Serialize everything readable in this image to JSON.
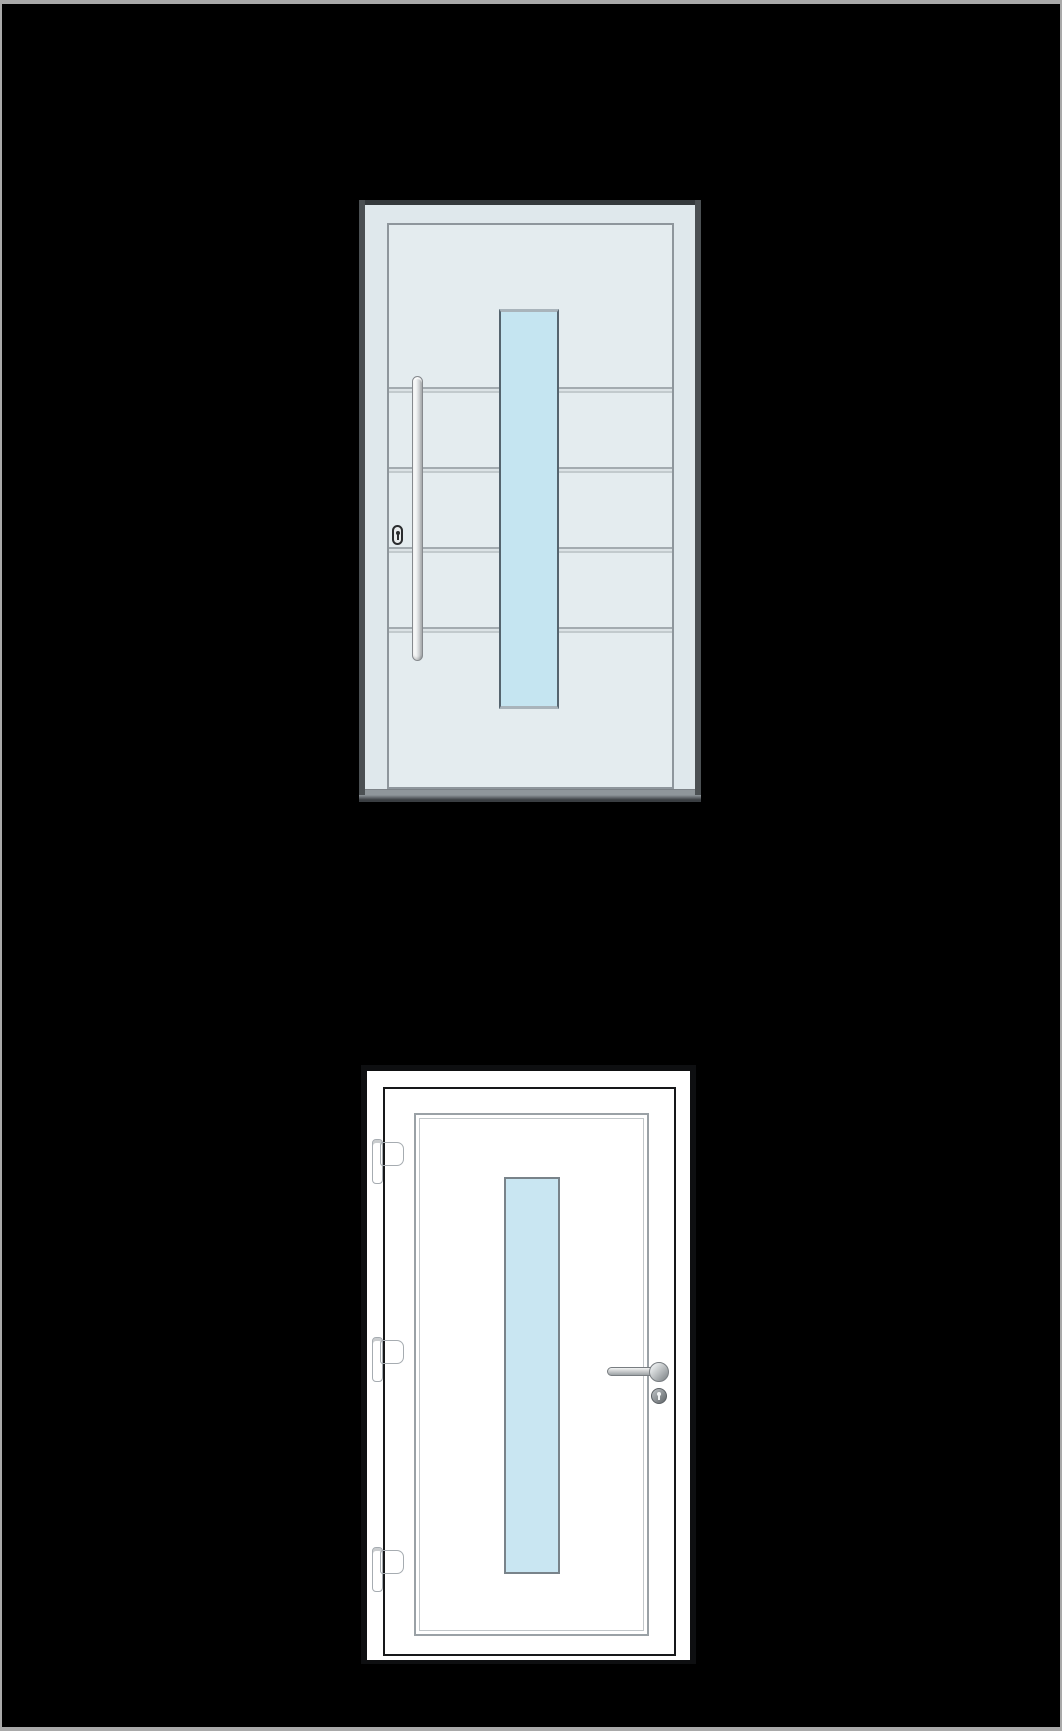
{
  "scene": {
    "kind": "two-entrance-door-product-illustrations",
    "background": "#000000",
    "page_border_color": "#a9a9a9"
  },
  "palette": {
    "bg": "#000000",
    "page_border": "#a9a9a9",
    "a_frame": "#dfe8ec",
    "a_leaf": "#e4ecef",
    "a_edge_top": "#34393c",
    "a_edge_side": "#4b5053",
    "a_edge_bottom": "#3a3e42",
    "a_leaf_line": "#8e969c",
    "a_groove_top": "#a3abb0",
    "a_groove_bottom": "#c2cacd",
    "a_groove_fill": "#dce3e6",
    "a_glass": "#c5e5f1",
    "a_glass_side": "#55646e",
    "a_glass_cap": "#a9b4bb",
    "a_handle_hi": "#fdfdfd",
    "a_handle_lo": "#9fa3a5",
    "a_handle_line": "#85898d",
    "a_lock_fill": "#e8ebec",
    "a_lock_line": "#2a2c2e",
    "a_sill": "#8f969b",
    "b_edge": "#0e0f11",
    "b_white": "#ffffff",
    "b_leaf_line": "#17181a",
    "b_bead_outer": "#9aa1a6",
    "b_bead_inner": "#c2c7ca",
    "b_glass": "#c9e6f2",
    "b_glass_line": "#79838a",
    "b_hinge_hi": "#f6f8f9",
    "b_hinge_lo": "#dcе0e2",
    "b_hinge_line": "#a6acb1",
    "b_lever_hi": "#f2f3f3",
    "b_lever_lo": "#9da2a5",
    "b_lever_line": "#787d81",
    "b_rosette_hi": "#e4e7e8",
    "b_rosette_lo": "#8d9295",
    "b_lockrose_hi": "#b0b5b8",
    "b_lockrose_lo": "#6e7376",
    "keyhole_dark": "#2a2c2e",
    "keyhole_light": "#f2f4f5"
  },
  "door_a": {
    "label": "aluminum entrance door with vertical glass strip, bar handle and profile cylinder",
    "bounds": {
      "x": 357,
      "y": 196,
      "w": 342,
      "h": 602
    },
    "leaf": {
      "x": 28,
      "y": 23,
      "w": 287,
      "h": 566
    },
    "grooves": [
      {
        "x": 0,
        "y": 162,
        "w": 283,
        "h": 6
      },
      {
        "x": 0,
        "y": 242,
        "w": 283,
        "h": 6
      },
      {
        "x": 0,
        "y": 322,
        "w": 283,
        "h": 6
      },
      {
        "x": 0,
        "y": 402,
        "w": 283,
        "h": 6
      }
    ],
    "glass": {
      "x": 110,
      "y": 84,
      "w": 60,
      "h": 400
    },
    "handle": {
      "x": 53,
      "y": 176,
      "w": 11,
      "h": 285
    },
    "lock": {
      "x": 33,
      "y": 325,
      "w": 11,
      "h": 20
    },
    "sill": {
      "x": 6,
      "y": 589,
      "w": 330,
      "h": 6
    }
  },
  "door_b": {
    "label": "white PVC door with vertical glass strip, three hinges, lever handle and lock rosette",
    "bounds": {
      "x": 359,
      "y": 1061,
      "w": 335,
      "h": 599
    },
    "leaf": {
      "x": 22,
      "y": 22,
      "w": 293,
      "h": 569
    },
    "bead": {
      "x": 29,
      "y": 24,
      "w": 235,
      "h": 523
    },
    "glass": {
      "x": 119,
      "y": 88,
      "w": 56,
      "h": 397
    },
    "hinges": [
      {
        "x": 9,
        "y": 74
      },
      {
        "x": 9,
        "y": 272
      },
      {
        "x": 9,
        "y": 482
      }
    ],
    "lever": {
      "x": 246,
      "y": 302,
      "w": 50,
      "h": 9
    },
    "rosette": {
      "x": 288,
      "y": 297,
      "w": 20,
      "h": 20
    },
    "lock_rosette": {
      "x": 290,
      "y": 323,
      "w": 16,
      "h": 16
    }
  }
}
